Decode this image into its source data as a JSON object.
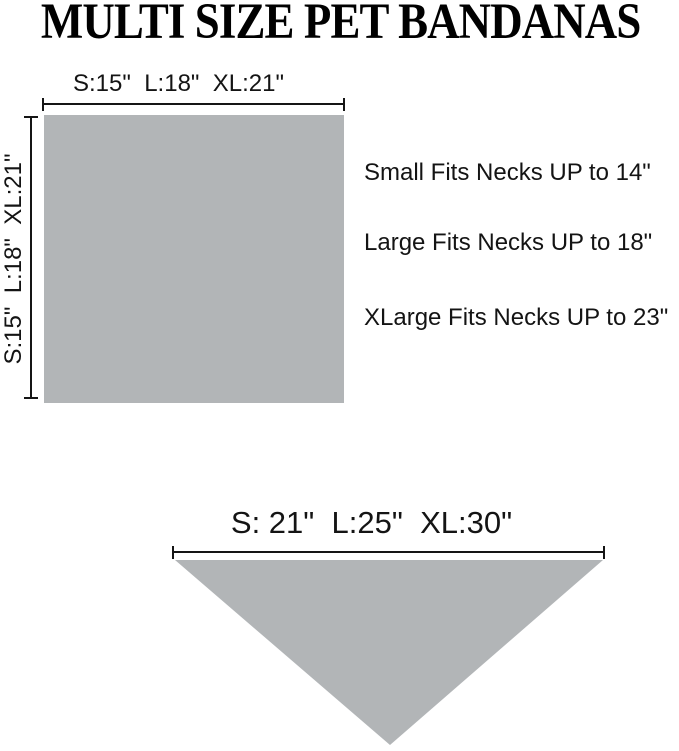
{
  "title": "MULTI SIZE PET BANDANAS",
  "colors": {
    "shape_gray": "#b2b5b7",
    "line_black": "#151515",
    "text_dark": "#141414",
    "title_black": "#000000"
  },
  "square_diagram": {
    "width_label": "S:15\"  L:18\"  XL:21\"",
    "height_label": "S:15\"  L:18\"  XL:21\""
  },
  "fit_notes": [
    "Small Fits Necks UP to 14\"",
    "Large Fits Necks UP to 18\"",
    "XLarge Fits Necks UP to 23\""
  ],
  "triangle_diagram": {
    "width_label": "S: 21\"  L:25\"  XL:30\""
  }
}
